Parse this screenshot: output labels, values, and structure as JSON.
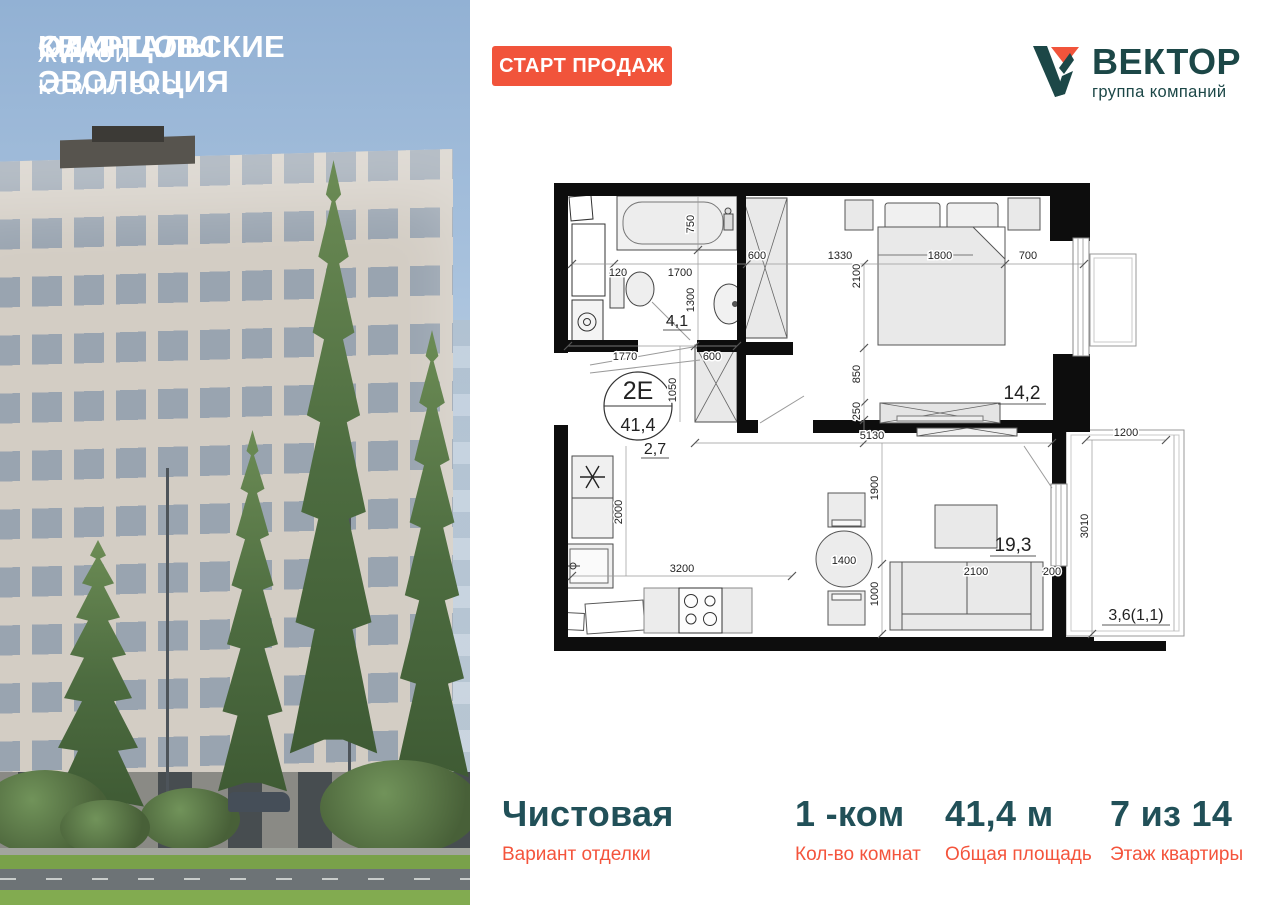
{
  "photo": {
    "title_line1": "ОДИНЦОВСКИЕ",
    "title_line2": "КВАРТАЛЫ ЭВОЛЮЦИЯ",
    "subtitle": "жилой комплекс"
  },
  "badge": {
    "label": "СТАРТ ПРОДАЖ"
  },
  "logo": {
    "name": "ВЕКТОР",
    "tagline": "группа компаний"
  },
  "floorplan": {
    "unit": {
      "type": "2Е",
      "area": "41,4"
    },
    "rooms": {
      "bathroom": "4,1",
      "hallway": "2,7",
      "bedroom": "14,2",
      "living": "19,3",
      "balcony": "3,6(1,1)"
    },
    "dims": {
      "tub_offset": "120",
      "tub_length": "1700",
      "tub_width": "750",
      "bath_depth": "1300",
      "entry_closet_width": "600",
      "bed_gap": "1330",
      "bed_width": "1800",
      "bed_side_gap": "700",
      "bed_length": "2100",
      "bed_foot_gap": "850",
      "dresser_depth": "250",
      "hall_width": "1770",
      "hall_closet_width": "600",
      "hall_closet_depth": "1050",
      "living_span": "5130",
      "kitchen_depth": "2000",
      "kitchen_run": "3200",
      "table_size": "1400",
      "living_depth1": "1900",
      "living_depth2": "1000",
      "sofa_length": "2100",
      "sofa_gap": "200",
      "balcony_width": "1200",
      "balcony_length": "3010"
    }
  },
  "footer": {
    "items": [
      {
        "value": "Чистовая",
        "label": "Вариант отделки"
      },
      {
        "value": "1 -ком",
        "label": "Кол-во комнат"
      },
      {
        "value": "41,4 м",
        "label": "Общая площадь"
      },
      {
        "value": "7 из 14",
        "label": "Этаж квартиры"
      }
    ]
  },
  "colors": {
    "accent_orange": "#F1543B",
    "brand_teal": "#1C4747",
    "stat_teal": "#215058"
  }
}
